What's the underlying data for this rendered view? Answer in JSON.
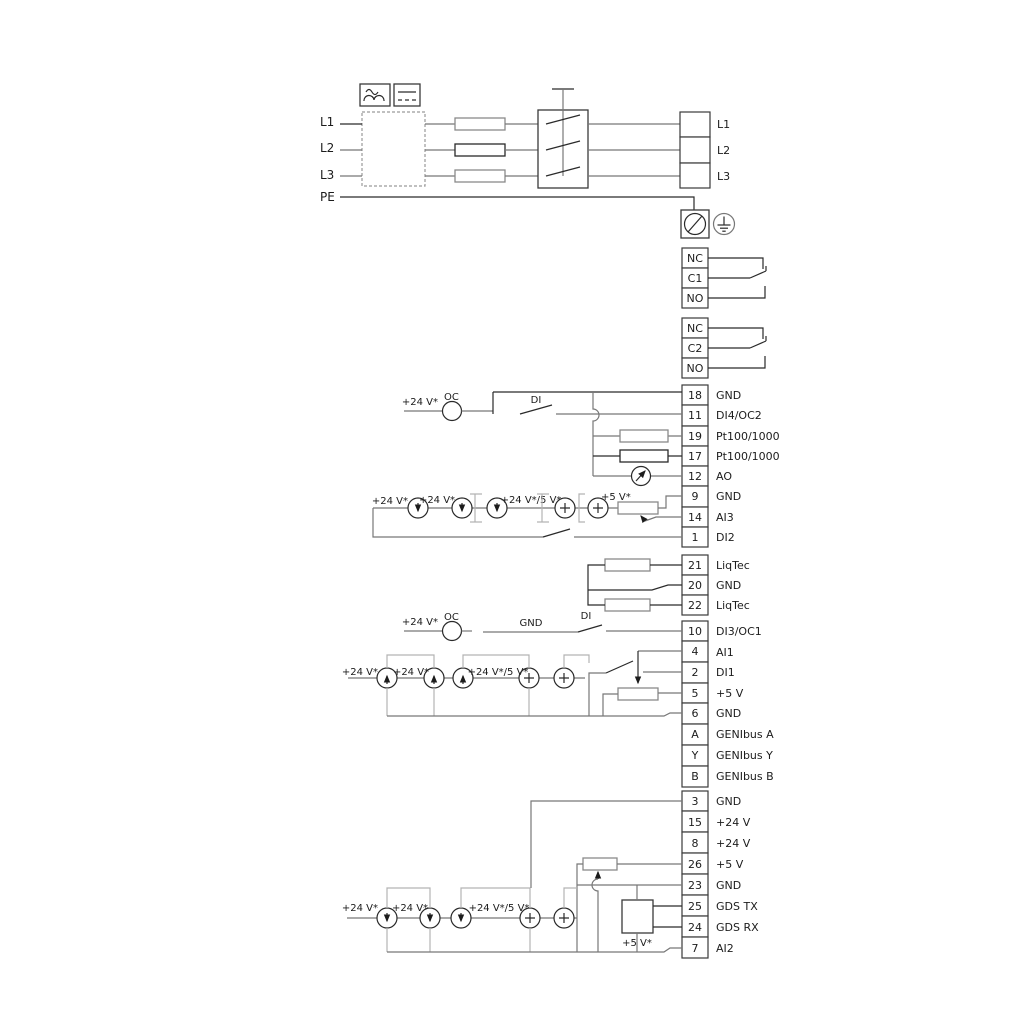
{
  "title": "Pump terminal wiring diagram",
  "colors": {
    "wire": "#777777",
    "dark": "#2a2a2a",
    "bracket": "#b3b3b3",
    "background": "#ffffff"
  },
  "power_in": {
    "l1": "L1",
    "l2": "L2",
    "l3": "L3",
    "pe": "PE"
  },
  "power_out": {
    "l1": "L1",
    "l2": "L2",
    "l3": "L3"
  },
  "relay1": {
    "nc": "NC",
    "c": "C1",
    "no": "NO"
  },
  "relay2": {
    "nc": "NC",
    "c": "C2",
    "no": "NO"
  },
  "io1": [
    {
      "num": "18",
      "label": "GND"
    },
    {
      "num": "11",
      "label": "DI4/OC2"
    },
    {
      "num": "19",
      "label": "Pt100/1000"
    },
    {
      "num": "17",
      "label": "Pt100/1000"
    },
    {
      "num": "12",
      "label": "AO"
    },
    {
      "num": "9",
      "label": "GND"
    },
    {
      "num": "14",
      "label": "AI3"
    },
    {
      "num": "1",
      "label": "DI2"
    }
  ],
  "liqtec": [
    {
      "num": "21",
      "label": "LiqTec"
    },
    {
      "num": "20",
      "label": "GND"
    },
    {
      "num": "22",
      "label": "LiqTec"
    }
  ],
  "io2": [
    {
      "num": "10",
      "label": "DI3/OC1"
    },
    {
      "num": "4",
      "label": "AI1"
    },
    {
      "num": "2",
      "label": "DI1"
    },
    {
      "num": "5",
      "label": "+5 V"
    },
    {
      "num": "6",
      "label": "GND"
    },
    {
      "num": "A",
      "label": "GENIbus A"
    },
    {
      "num": "Y",
      "label": "GENIbus Y"
    },
    {
      "num": "B",
      "label": "GENIbus B"
    }
  ],
  "io3": [
    {
      "num": "3",
      "label": "GND"
    },
    {
      "num": "15",
      "label": "+24 V"
    },
    {
      "num": "8",
      "label": "+24 V"
    },
    {
      "num": "26",
      "label": "+5 V"
    },
    {
      "num": "23",
      "label": "GND"
    },
    {
      "num": "25",
      "label": "GDS TX"
    },
    {
      "num": "24",
      "label": "GDS RX"
    },
    {
      "num": "7",
      "label": "AI2"
    }
  ],
  "ann": {
    "s1": {
      "v24": "+24 V*",
      "oc": "OC",
      "di": "DI"
    },
    "s2": {
      "v24a": "+24 V*",
      "v24b": "+24 V*",
      "v245": "+24 V*/5 V*",
      "v5": "+5 V*"
    },
    "s3": {
      "v24": "+24 V*",
      "oc": "OC",
      "gnd": "GND",
      "di": "DI"
    },
    "s4": {
      "v24a": "+24 V*",
      "v24b": "+24 V*",
      "v245": "+24 V*/5 V*"
    },
    "s5": {
      "v24a": "+24 V*",
      "v24b": "+24 V*",
      "v245": "+24 V*/5 V*",
      "v5": "+5 V*"
    }
  }
}
